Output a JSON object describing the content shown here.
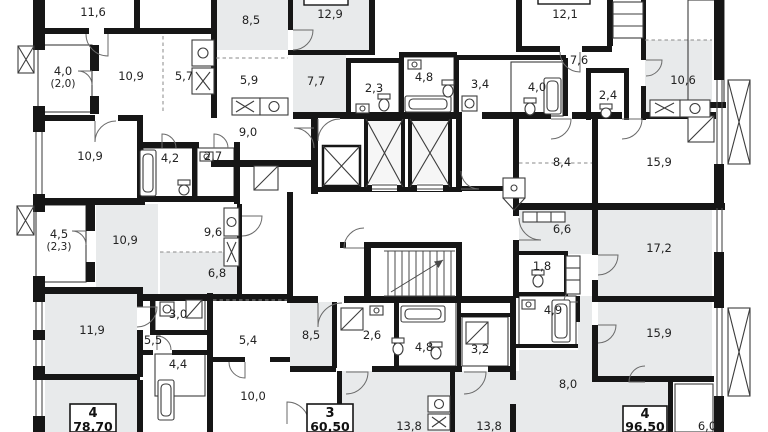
{
  "meta": {
    "drawing_type": "residential-floor-plan",
    "note": "apartment floor plan fragment with elevator core and stairwell"
  },
  "palette": {
    "wall": "#161616",
    "room_gray": "#e8eaeb",
    "room_white": "#ffffff",
    "tile_bg": "#f2f4f4",
    "tile_line": "#d9dede",
    "hatch_bg": "#eef0f0",
    "hatch_line": "#d2d7d8",
    "text": "#222222"
  },
  "rooms": [
    {
      "t": "11,6",
      "x": 93,
      "y": 16
    },
    {
      "t": "10,9",
      "x": 131,
      "y": 80
    },
    {
      "t": "5,7",
      "x": 184,
      "y": 80
    },
    {
      "t": "4,0",
      "x": 63,
      "y": 75,
      "sub": "(2,0)"
    },
    {
      "t": "10,9",
      "x": 90,
      "y": 160
    },
    {
      "t": "4,2",
      "x": 170,
      "y": 162
    },
    {
      "t": "2,7",
      "x": 213,
      "y": 160
    },
    {
      "t": "4,5",
      "x": 59,
      "y": 238,
      "sub": "(2,3)"
    },
    {
      "t": "10,9",
      "x": 125,
      "y": 244
    },
    {
      "t": "9,6",
      "x": 213,
      "y": 236
    },
    {
      "t": "6,8",
      "x": 217,
      "y": 277
    },
    {
      "t": "11,9",
      "x": 92,
      "y": 334
    },
    {
      "t": "3,0",
      "x": 178,
      "y": 318
    },
    {
      "t": "5,5",
      "x": 153,
      "y": 344
    },
    {
      "t": "4,4",
      "x": 178,
      "y": 368
    },
    {
      "t": "5,4",
      "x": 248,
      "y": 344
    },
    {
      "t": "10,0",
      "x": 253,
      "y": 400
    },
    {
      "t": "8,5",
      "x": 251,
      "y": 24
    },
    {
      "t": "12,9",
      "x": 330,
      "y": 18
    },
    {
      "t": "5,9",
      "x": 249,
      "y": 84
    },
    {
      "t": "9,0",
      "x": 248,
      "y": 136
    },
    {
      "t": "7,7",
      "x": 316,
      "y": 85
    },
    {
      "t": "2,3",
      "x": 374,
      "y": 92
    },
    {
      "t": "4,8",
      "x": 424,
      "y": 81
    },
    {
      "t": "3,4",
      "x": 480,
      "y": 88
    },
    {
      "t": "4,0",
      "x": 537,
      "y": 91
    },
    {
      "t": "12,1",
      "x": 565,
      "y": 18
    },
    {
      "t": "7,6",
      "x": 579,
      "y": 64
    },
    {
      "t": "2,4",
      "x": 608,
      "y": 99
    },
    {
      "t": "10,6",
      "x": 683,
      "y": 84
    },
    {
      "t": "8,4",
      "x": 562,
      "y": 166
    },
    {
      "t": "15,9",
      "x": 659,
      "y": 166
    },
    {
      "t": "6,6",
      "x": 562,
      "y": 233
    },
    {
      "t": "17,2",
      "x": 659,
      "y": 252
    },
    {
      "t": "1,8",
      "x": 542,
      "y": 270
    },
    {
      "t": "4,9",
      "x": 553,
      "y": 314
    },
    {
      "t": "15,9",
      "x": 659,
      "y": 337
    },
    {
      "t": "8,0",
      "x": 568,
      "y": 388
    },
    {
      "t": "6,0",
      "x": 707,
      "y": 430
    },
    {
      "t": "8,5",
      "x": 311,
      "y": 339
    },
    {
      "t": "2,6",
      "x": 372,
      "y": 339
    },
    {
      "t": "4,8",
      "x": 424,
      "y": 351
    },
    {
      "t": "3,2",
      "x": 480,
      "y": 353
    },
    {
      "t": "13,8",
      "x": 409,
      "y": 430
    },
    {
      "t": "13,8",
      "x": 489,
      "y": 430
    }
  ],
  "apartments": [
    {
      "rooms": "4",
      "area": "78,70"
    },
    {
      "rooms": "3",
      "area": "60,50"
    },
    {
      "rooms": "4",
      "area": "96,50"
    }
  ]
}
